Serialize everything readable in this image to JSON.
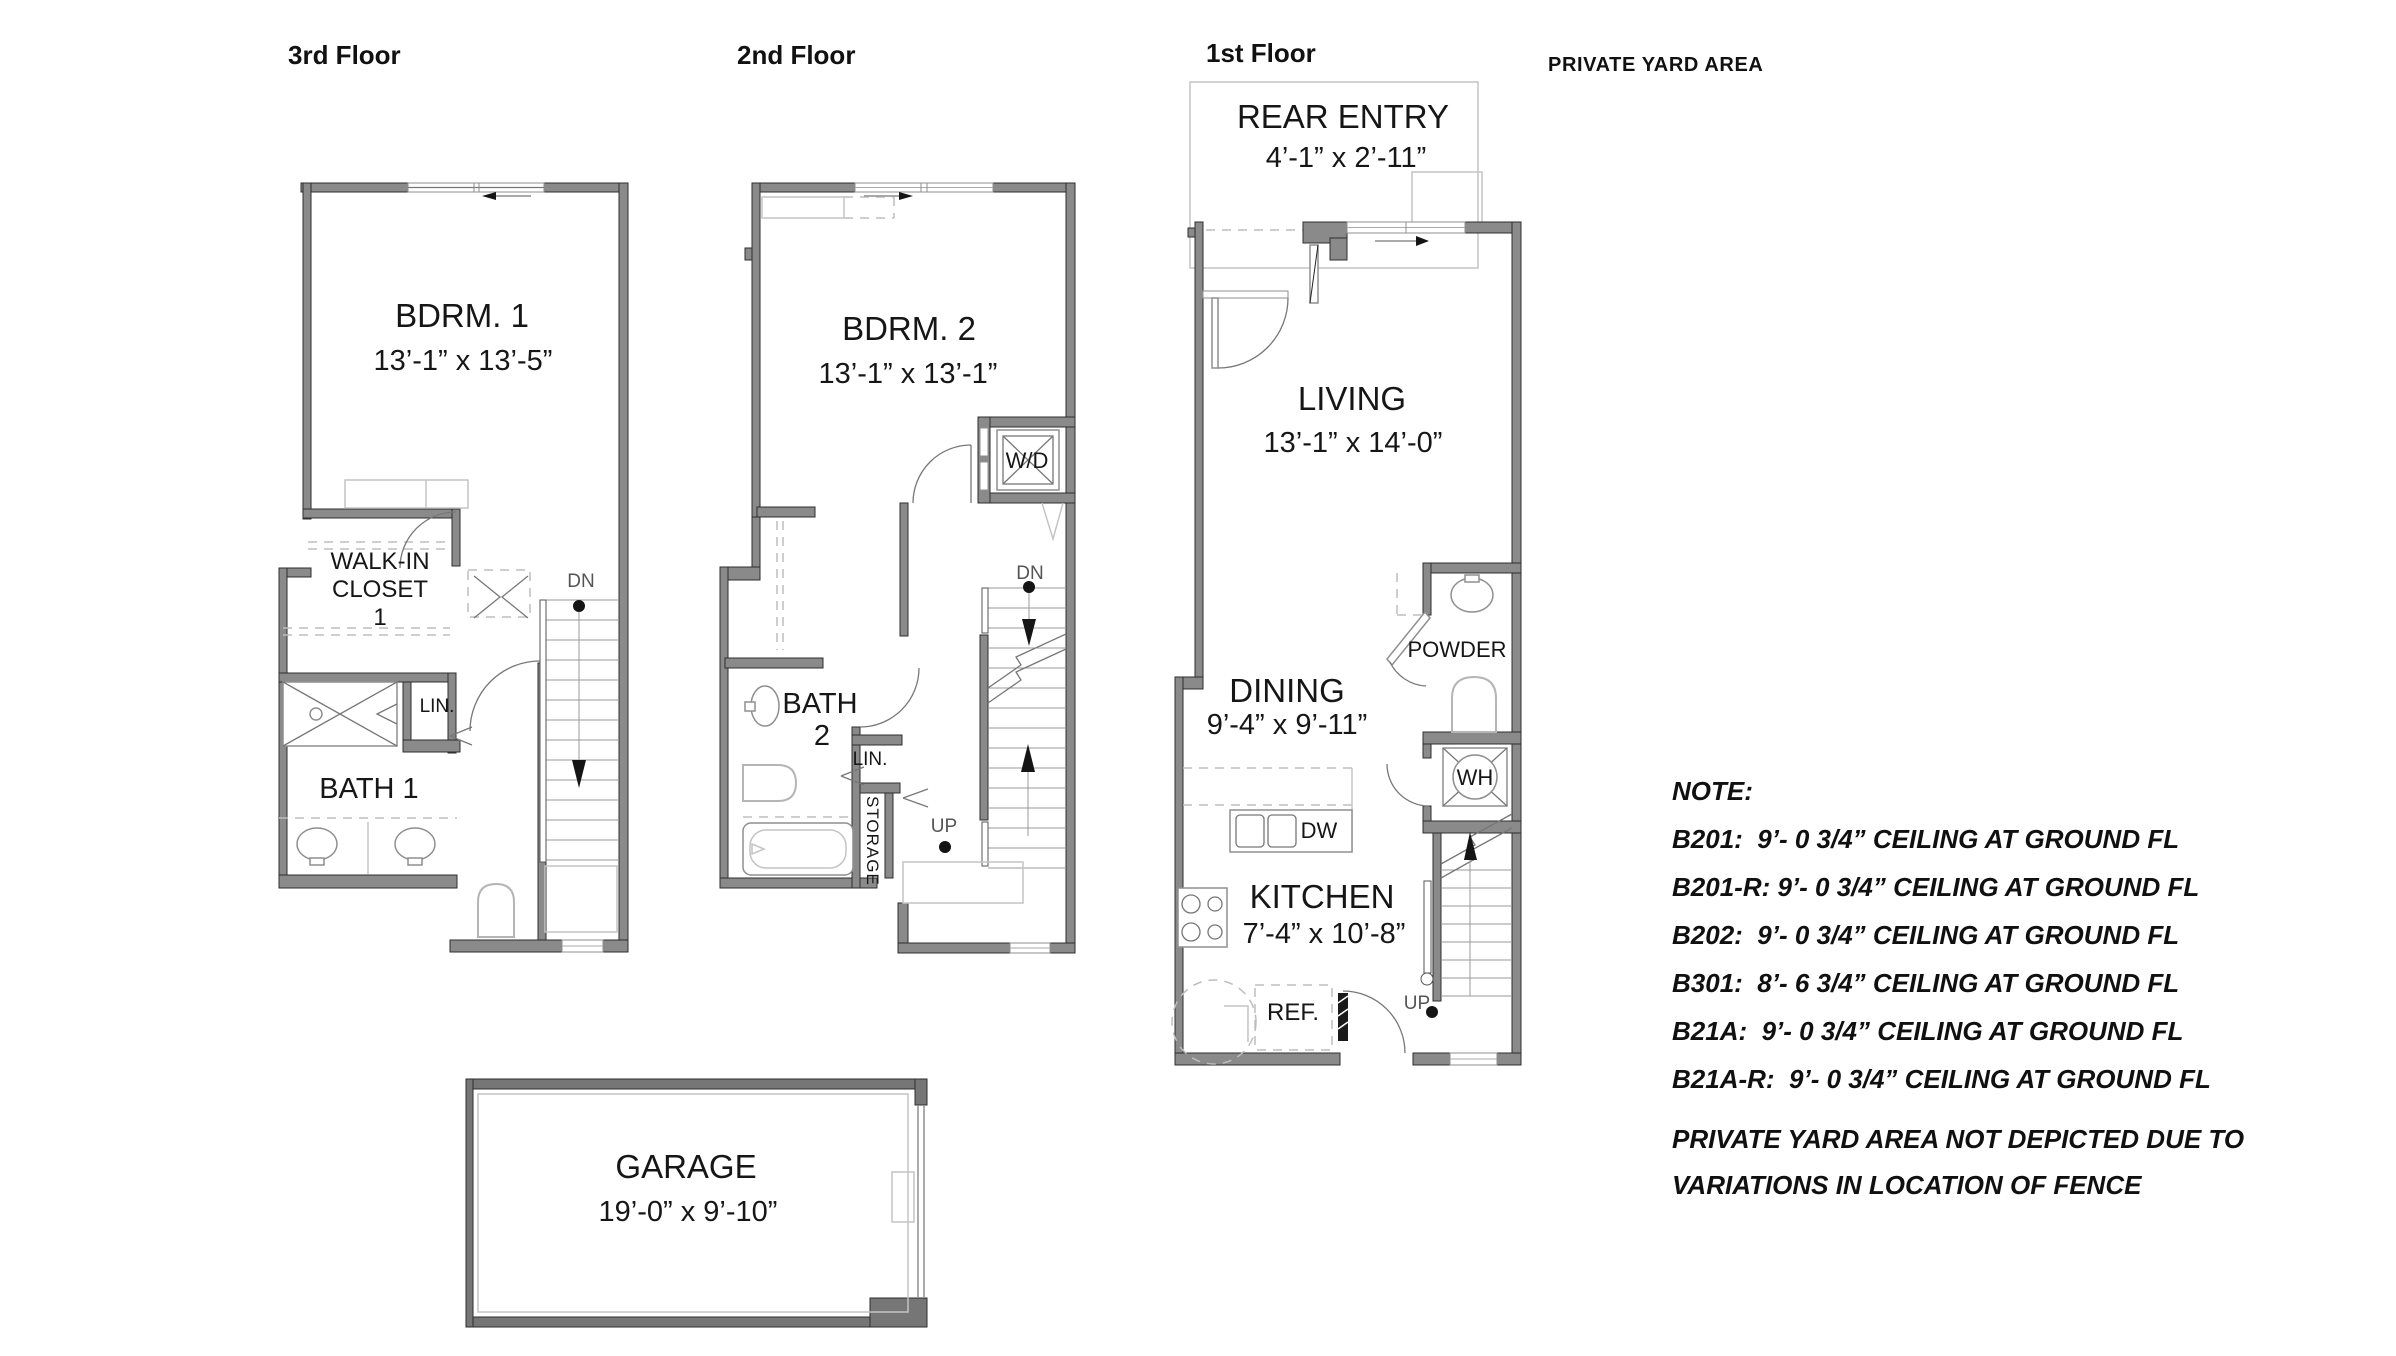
{
  "titles": {
    "floor3": "3rd Floor",
    "floor2": "2nd Floor",
    "floor1": "1st Floor",
    "yard": "PRIVATE YARD AREA"
  },
  "floor3": {
    "bdrm": {
      "name": "BDRM. 1",
      "dims": "13’-1” x 13’-5”"
    },
    "walkin": [
      "WALK-IN",
      "CLOSET",
      "1"
    ],
    "bath": "BATH 1",
    "lin": "LIN.",
    "dn": "DN"
  },
  "floor2": {
    "bdrm": {
      "name": "BDRM. 2",
      "dims": "13’-1” x 13’-1”"
    },
    "bath": [
      "BATH",
      "2"
    ],
    "wd": "W/D",
    "lin": "LIN.",
    "storage": "STORAGE",
    "dn": "DN",
    "up": "UP"
  },
  "floor1": {
    "rear_entry": {
      "name": "REAR ENTRY",
      "dims": "4’-1” x 2’-11”"
    },
    "living": {
      "name": "LIVING",
      "dims": "13’-1” x 14’-0”"
    },
    "dining": {
      "name": "DINING",
      "dims": "9’-4” x 9’-11”"
    },
    "kitchen": {
      "name": "KITCHEN",
      "dims": "7’-4” x 10’-8”"
    },
    "powder": "POWDER",
    "wh": "WH",
    "dw": "DW",
    "ref": "REF.",
    "up": "UP"
  },
  "garage": {
    "name": "GARAGE",
    "dims": "19’-0” x 9’-10”"
  },
  "notes": {
    "heading": "NOTE:",
    "lines": [
      "B201:  9’- 0 3/4” CEILING AT GROUND FL",
      "B201-R: 9’- 0 3/4” CEILING AT GROUND FL",
      "B202:  9’- 0 3/4” CEILING AT GROUND FL",
      "B301:  8’- 6 3/4” CEILING AT GROUND FL",
      "B21A:  9’- 0 3/4” CEILING AT GROUND FL",
      "B21A-R:  9’- 0 3/4” CEILING AT GROUND FL"
    ],
    "footer": [
      "PRIVATE YARD AREA NOT DEPICTED DUE TO",
      "VARIATIONS IN LOCATION OF FENCE"
    ]
  },
  "colors": {
    "wall": "#8a8a8a",
    "garage_wall": "#767676",
    "outline": "#2e2e2e",
    "text": "#161616"
  }
}
